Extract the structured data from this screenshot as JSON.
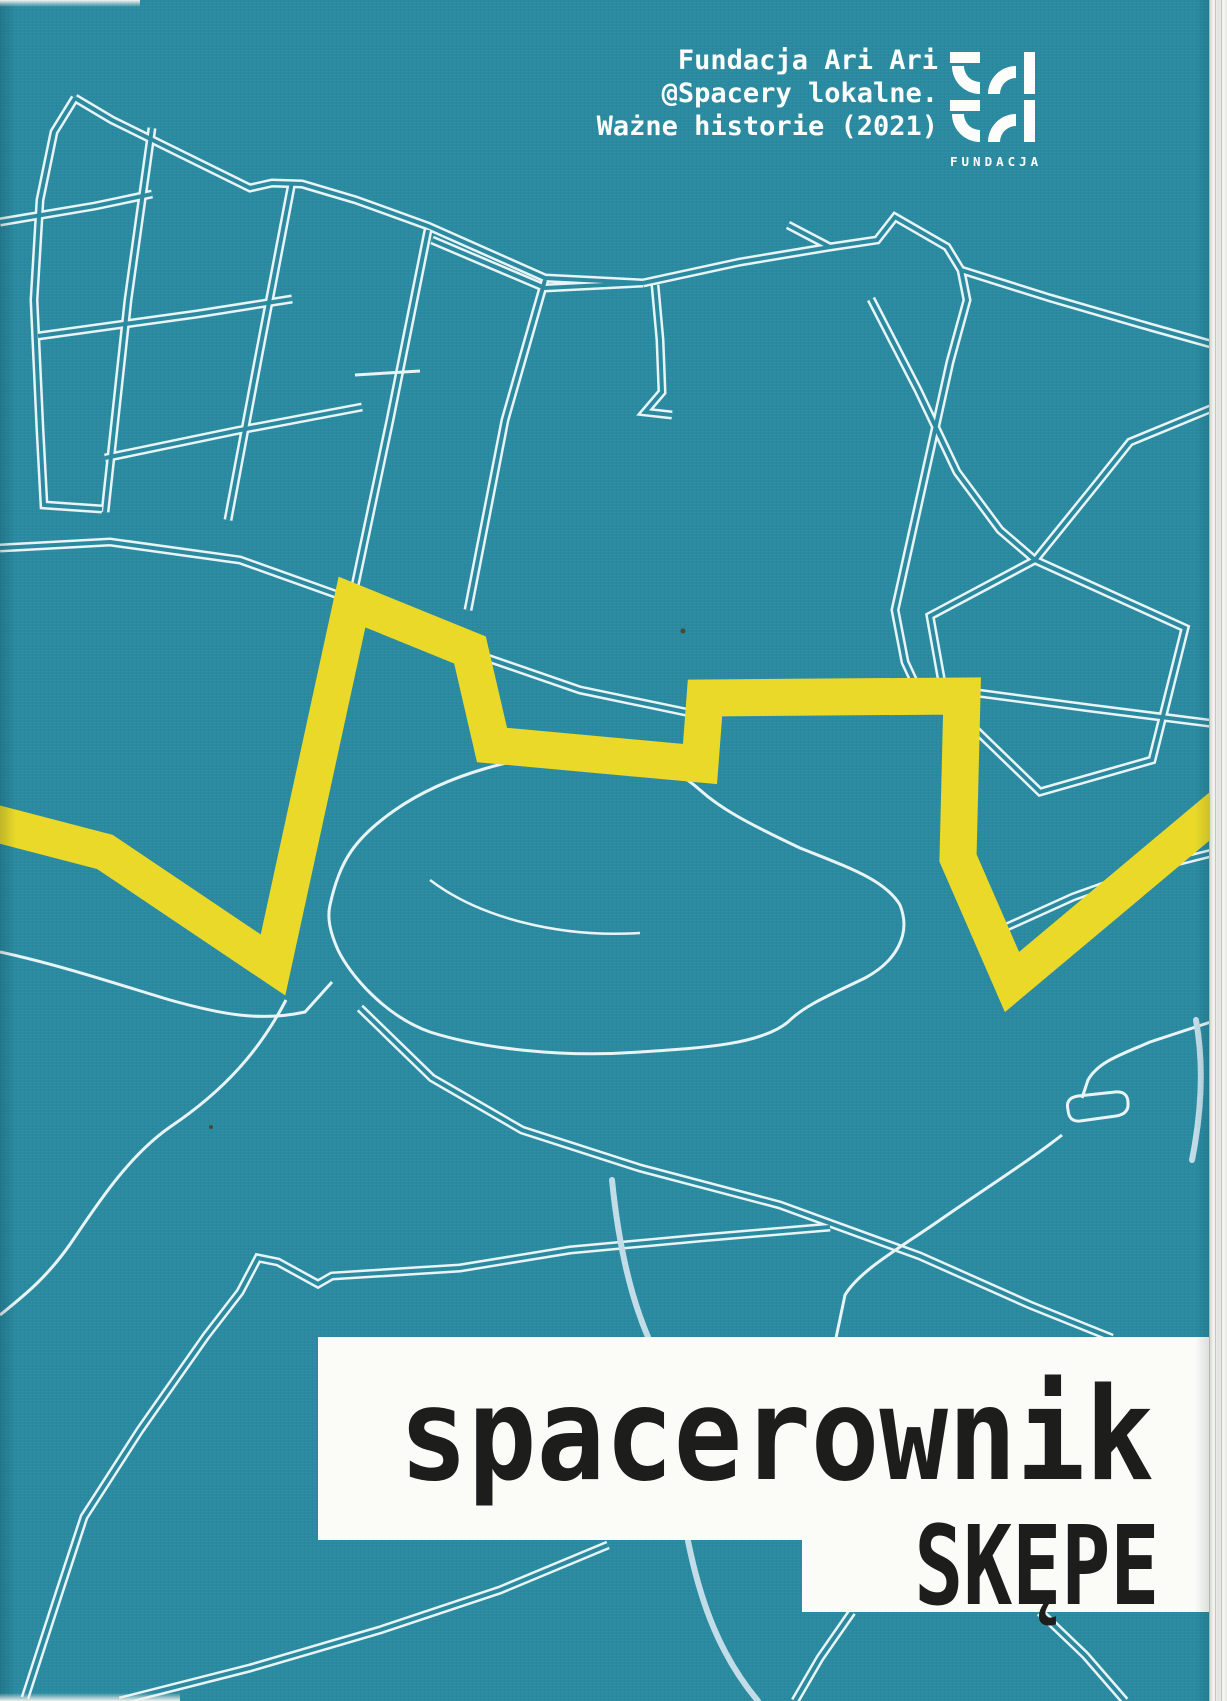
{
  "cover": {
    "credits": {
      "line1": "Fundacja Ari Ari",
      "line2": "@Spacery lokalne.",
      "line3": "Ważne historie (2021)"
    },
    "logo": {
      "caption": "FUNDACJA"
    },
    "title": {
      "main": "spacerownik",
      "sub": "SKĘPE"
    },
    "colors": {
      "background_teal": "#2b8aa0",
      "route_yellow": "#ead929",
      "road_white": "#e9f4f6",
      "pale_river": "#c3dde8",
      "title_text": "#1d1d1b",
      "panel_white": "#fbfbf8"
    }
  }
}
